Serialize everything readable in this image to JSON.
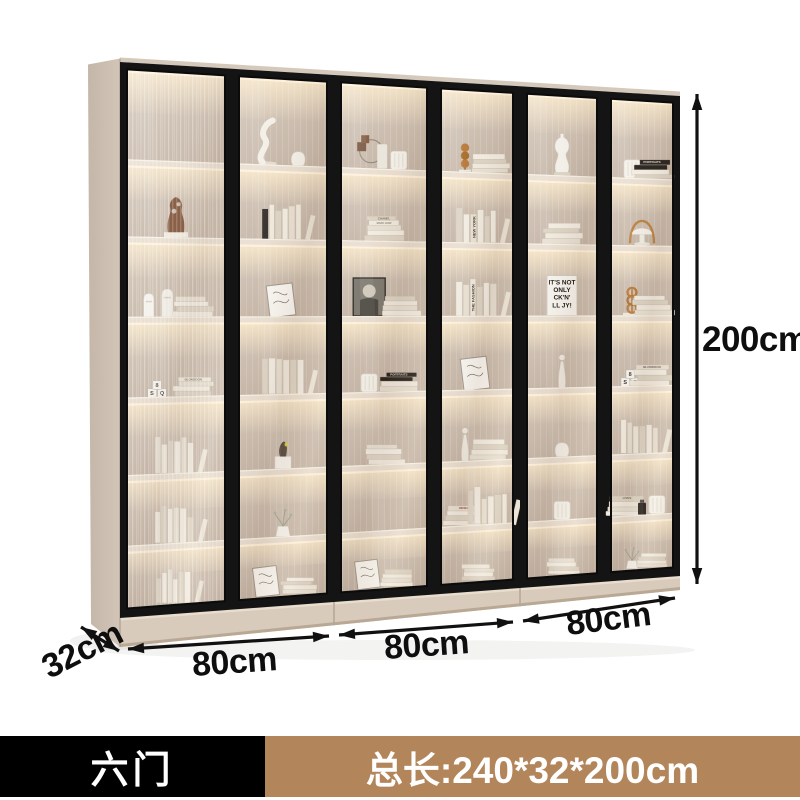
{
  "canvas": {
    "width": 800,
    "height": 800,
    "background": "#ffffff"
  },
  "dimensions": {
    "height": "200cm",
    "module_widths": [
      "80cm",
      "80cm",
      "80cm"
    ],
    "depth": "32cm"
  },
  "footer": {
    "variant": "六门",
    "total": "总长:240*32*200cm",
    "variant_bg": "#000000",
    "total_bg": "#b3855a",
    "text_color": "#ffffff"
  },
  "annotation_color": "#111111",
  "cabinet": {
    "doors": 6,
    "rows": 7,
    "frame_color": "#141414",
    "body_color": "#c9bbae",
    "interior_color": "#cbbcae",
    "shelf_color": "#e8ddcf",
    "glow_color": "#ffedca",
    "book_titles": {
      "chanel": "CHANEL",
      "marc_how": "MARC HOW",
      "new_york": "NEW YORK",
      "the_fashion": "THE FASHION",
      "rock_print": [
        "IT'S NOT",
        "ONLY",
        "CK'N'",
        "LL JY!"
      ],
      "blondoon": "BLONDOON",
      "lives": "LIVES",
      "portraits": "PORTRAITS",
      "design": "DESIGN"
    },
    "decor": [
      [
        [],
        [
          "sculptBrown"
        ],
        [
          "figurines",
          "stack"
        ],
        [
          "blocks",
          "stackB"
        ],
        [
          "vbooks"
        ],
        [
          "vbooks"
        ],
        [
          "vbooks"
        ]
      ],
      [
        [
          "sculptCurvy",
          "vase"
        ],
        [
          "vbooksDark"
        ],
        [
          "frameArt"
        ],
        [
          "vbooks"
        ],
        [
          "vaseFigure"
        ],
        [
          "plant"
        ],
        [
          "frameArt",
          "stack"
        ]
      ],
      [
        [
          "ringstand",
          "vaseRibbed"
        ],
        [
          "stackChanel"
        ],
        [
          "portrait",
          "stack"
        ],
        [
          "vaseRibbed",
          "stackDark"
        ],
        [
          "stack"
        ],
        [],
        [
          "frameArt",
          "stack"
        ]
      ],
      [
        [
          "spheres",
          "stack"
        ],
        [
          "vbooksNY"
        ],
        [
          "vbooksFashion"
        ],
        [
          "frameArt"
        ],
        [
          "statue",
          "stack"
        ],
        [
          "stackDesign",
          "vbooks"
        ],
        [
          "stack"
        ]
      ],
      [
        [
          "torso"
        ],
        [
          "stack"
        ],
        [
          "printText"
        ],
        [
          "statue"
        ],
        [
          "vase"
        ],
        [
          "vaseRibbed"
        ],
        [
          "stack"
        ]
      ],
      [
        [
          "vaseRibbed",
          "stackDark"
        ],
        [
          "lamp"
        ],
        [
          "rings",
          "stack"
        ],
        [
          "blocks",
          "stackB"
        ],
        [
          "vbooks"
        ],
        [
          "stackLives",
          "bottle",
          "vaseRibbed"
        ],
        [
          "plant",
          "stack"
        ]
      ]
    ]
  }
}
